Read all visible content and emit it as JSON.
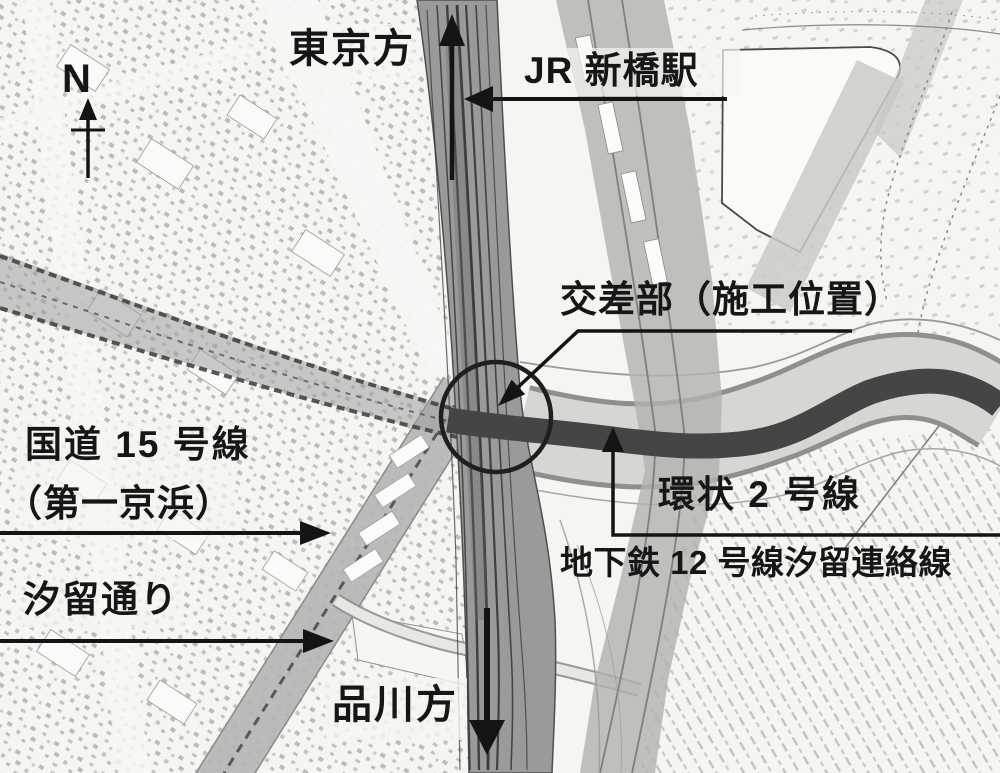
{
  "labels": {
    "north": "N",
    "tokyo_direction": "東京方",
    "jr_shimbashi_station": "JR 新橋駅",
    "intersection": "交差部（施工位置）",
    "route15": "国道 15 号線",
    "daiichi_keihin": "（第一京浜）",
    "shiodome_street": "汐留通り",
    "ring_road_2": "環状 2 号線",
    "subway_line12": "地下鉄 12 号線汐留連絡線",
    "shinagawa_direction": "品川方"
  },
  "icons": {
    "north_arrow": "↑",
    "up_arrow": "↑",
    "down_arrow": "↓",
    "left_arrow": "←",
    "right_arrow": "→"
  },
  "colors": {
    "paper": "#f6f5f1",
    "ink": "#161616",
    "railway_band": "#9a9a9a",
    "route15_band": "#b5b5b5",
    "ring_road_dark": "#454545",
    "corridor_light": "#d8d6d2"
  }
}
